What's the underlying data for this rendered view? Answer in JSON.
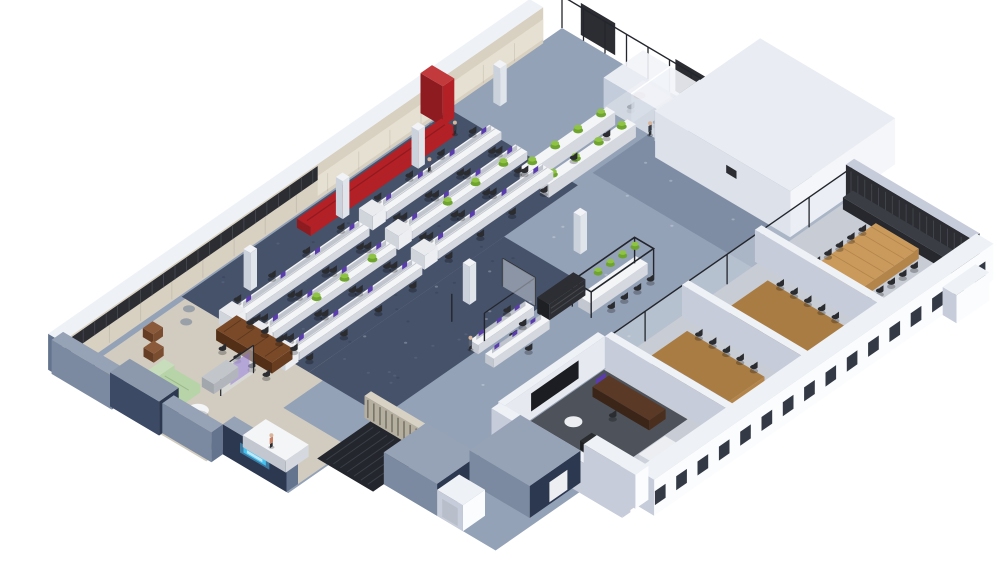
{
  "scene": {
    "kind": "isometric-office-floorplan-render",
    "areas": [
      {
        "name": "open-plan-workstations"
      },
      {
        "name": "standing-collaboration-counters"
      },
      {
        "name": "cafe-bar-counter"
      },
      {
        "name": "central-walkway"
      },
      {
        "name": "phone-booths"
      },
      {
        "name": "service-block"
      },
      {
        "name": "boardroom"
      },
      {
        "name": "meeting-room-1"
      },
      {
        "name": "meeting-room-2"
      },
      {
        "name": "executive-suite"
      },
      {
        "name": "lounge"
      },
      {
        "name": "reception"
      },
      {
        "name": "stair-core"
      }
    ],
    "reception_sign": {
      "glow_color": "#45c4f1"
    }
  },
  "colors": {
    "background": "#ffffff",
    "floor_walkway": "#94a2b7",
    "floor_walkway_dark": "#7e8da4",
    "carpet_office": "#46526a",
    "carpet_speckle_dark": "#39445a",
    "carpet_speckle_light": "#5a6880",
    "floor_rooms": "#c8ccd4",
    "floor_lounge": "#d2ccc0",
    "floor_stair_void": "#23262d",
    "rug_exec": "#4e525a",
    "wall_top": "#eef1f6",
    "wall_white_face": "#fbfcfe",
    "wall_light_side": "#c6ccd9",
    "wall_slate_top": "#96a2b5",
    "wall_slate_face": "#64748e",
    "wall_slate_side": "#7b8aa0",
    "wall_navy": "#2c3750",
    "wall_navy_side": "#3c4a66",
    "wall_beige": "#d8d1c2",
    "wall_beige_light": "#e6e0d2",
    "slat_dark": "#2b2d33",
    "slat_line": "#46494f",
    "glass_frame": "#23262c",
    "glass_fill": "rgba(223,230,240,0.45)",
    "accent_red": "#b32025",
    "accent_red_dark": "#8e1b20",
    "accent_red_top": "#c23a3c",
    "desk_white": "#f4f5f7",
    "desk_side": "#d5d8de",
    "desk_side2": "#c3c7cf",
    "divider_gray": "#babfc7",
    "screen_purple": "#5a3cae",
    "plant_green": "#8fc344",
    "plant_green_dark": "#6fa52f",
    "wood_light": "#c99a5c",
    "wood_plank": "#b4854b",
    "wood_mid": "#a97c44",
    "wood_dark": "#5a3a27",
    "wood_lounge": "#7a4a28",
    "sofa_sage": "#b7d3a8",
    "sofa_sage_light": "#c8ddbb",
    "sofa_gray": "#c2c6cb",
    "chair_dark": "#2a2c30",
    "pouf_yellow": "#e8c437",
    "pouf_gray": "#9aa0a8",
    "armchair_brown": "#8a5a3b",
    "neon_blue": "#45c4f1",
    "neon_blue_core": "#bfe9fb",
    "glow_purple": "rgba(138,106,216,0.45)",
    "credenza_white": "#eceef2",
    "block_top": "#e9ecf2",
    "block_face": "#f5f6fa",
    "block_side": "#dce1ea",
    "locker": "#e9ebef",
    "locker_side": "#d0d4db",
    "shelf_dark": "#2c2e33",
    "rail_wood": "#d8d2c4",
    "person_dark": "#353b47",
    "person_accent": "#c97f63",
    "skin": "#d8b49a",
    "step_line": "#3a3e46"
  }
}
